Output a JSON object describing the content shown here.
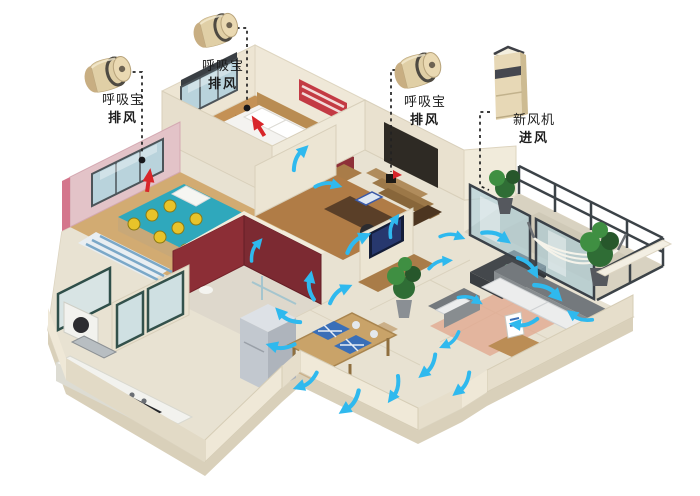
{
  "scene": {
    "description": "3D isometric apartment cutaway showing fresh-air ventilation system airflow",
    "background": "#ffffff"
  },
  "labels": {
    "exhaust_child": {
      "line1": "呼吸宝",
      "line2": "排风"
    },
    "exhaust_master": {
      "line1": "呼吸宝",
      "line2": "排风"
    },
    "exhaust_study": {
      "line1": "呼吸宝",
      "line2": "排风"
    },
    "fresh_air": {
      "line1": "新风机",
      "line2": "进风"
    }
  },
  "colors": {
    "airflow_arrow": "#2fb9ee",
    "exhaust_marker": "#d8262a",
    "device_gold": "#e0cfa6",
    "leader_line": "#222222",
    "wall_cream": "#ece4d2",
    "wall_pink": "#e3c3c8",
    "wall_red": "#8c2e36",
    "floor_wood": "#c49155",
    "floor_tile": "#e8e2d2",
    "sofa_gray": "#7e8487"
  }
}
